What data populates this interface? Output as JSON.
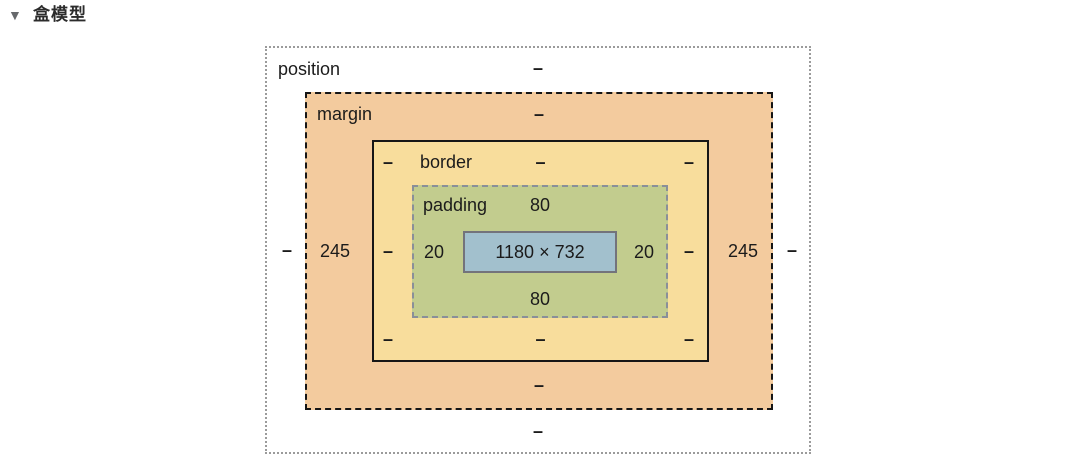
{
  "panel": {
    "collapse_icon": "▼",
    "title": "盒模型"
  },
  "box_model": {
    "position": {
      "label": "position",
      "top": "–",
      "right": "–",
      "bottom": "–",
      "left": "–"
    },
    "margin": {
      "label": "margin",
      "top": "–",
      "right": "245",
      "bottom": "–",
      "left": "245"
    },
    "border": {
      "label": "border",
      "top": "–",
      "right": "–",
      "bottom": "–",
      "left": "–",
      "radius_top_left": "–",
      "radius_top_right": "–",
      "radius_bottom_left": "–",
      "radius_bottom_right": "–"
    },
    "padding": {
      "label": "padding",
      "top": "80",
      "right": "20",
      "bottom": "80",
      "left": "20"
    },
    "content": {
      "size": "1180 × 732"
    }
  },
  "colors": {
    "margin_fill": "#f3cb9e",
    "border_fill": "#f8dd9c",
    "padding_fill": "#c2cc8e",
    "content_fill": "#a2c0cd",
    "position_border": "#9b9b9b",
    "box_line": "#161616",
    "padding_border": "#8a8f99",
    "content_border": "#73737b"
  }
}
